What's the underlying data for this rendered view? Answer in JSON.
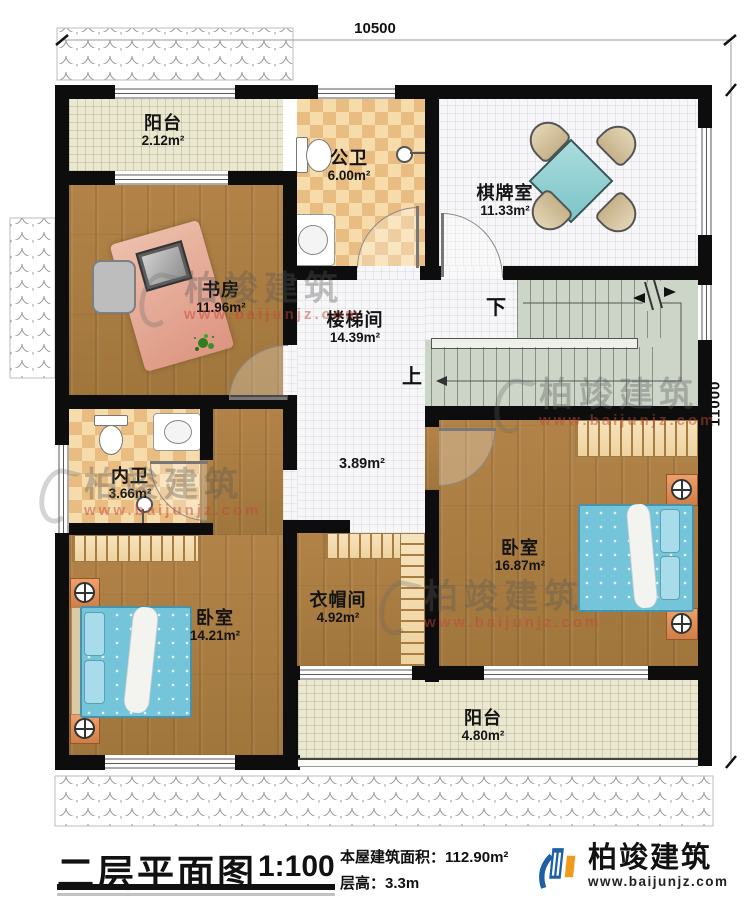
{
  "dimensions": {
    "top": "10500",
    "right": "11000"
  },
  "rooms": {
    "balcony_top": {
      "name": "阳台",
      "area": "2.12m²"
    },
    "public_bath": {
      "name": "公卫",
      "area": "6.00m²"
    },
    "game_room": {
      "name": "棋牌室",
      "area": "11.33m²"
    },
    "study": {
      "name": "书房",
      "area": "11.96m²"
    },
    "stair_hall": {
      "name": "楼梯间",
      "area": "14.39m²"
    },
    "hall_patch": {
      "area": "3.89m²"
    },
    "inner_bath": {
      "name": "内卫",
      "area": "3.66m²"
    },
    "bedroom_right": {
      "name": "卧室",
      "area": "16.87m²"
    },
    "bedroom_left": {
      "name": "卧室",
      "area": "14.21m²"
    },
    "cloakroom": {
      "name": "衣帽间",
      "area": "4.92m²"
    },
    "balcony_bottom": {
      "name": "阳台",
      "area": "4.80m²"
    }
  },
  "stairs": {
    "up": "上",
    "down": "下"
  },
  "watermark": {
    "name": "柏竣建筑",
    "url": "www.baijunjz.com"
  },
  "title_block": {
    "title": "二层平面图",
    "scale": "1:100",
    "area_label": "本屋建筑面积：",
    "area_value": "112.90m²",
    "height_label": "层高：",
    "height_value": "3.3m"
  },
  "brand": {
    "name": "柏竣建筑",
    "url": "www.baijunjz.com"
  },
  "colors": {
    "wall": "#0d0d0d",
    "wood": "#aa7c41",
    "tile": "#e9bd82",
    "bed": "#74c4da",
    "stairs": "#cdd5c8",
    "balcony": "#ebe8d1",
    "logo_blue": "#1f5fa8",
    "logo_orange": "#f29a1d"
  }
}
